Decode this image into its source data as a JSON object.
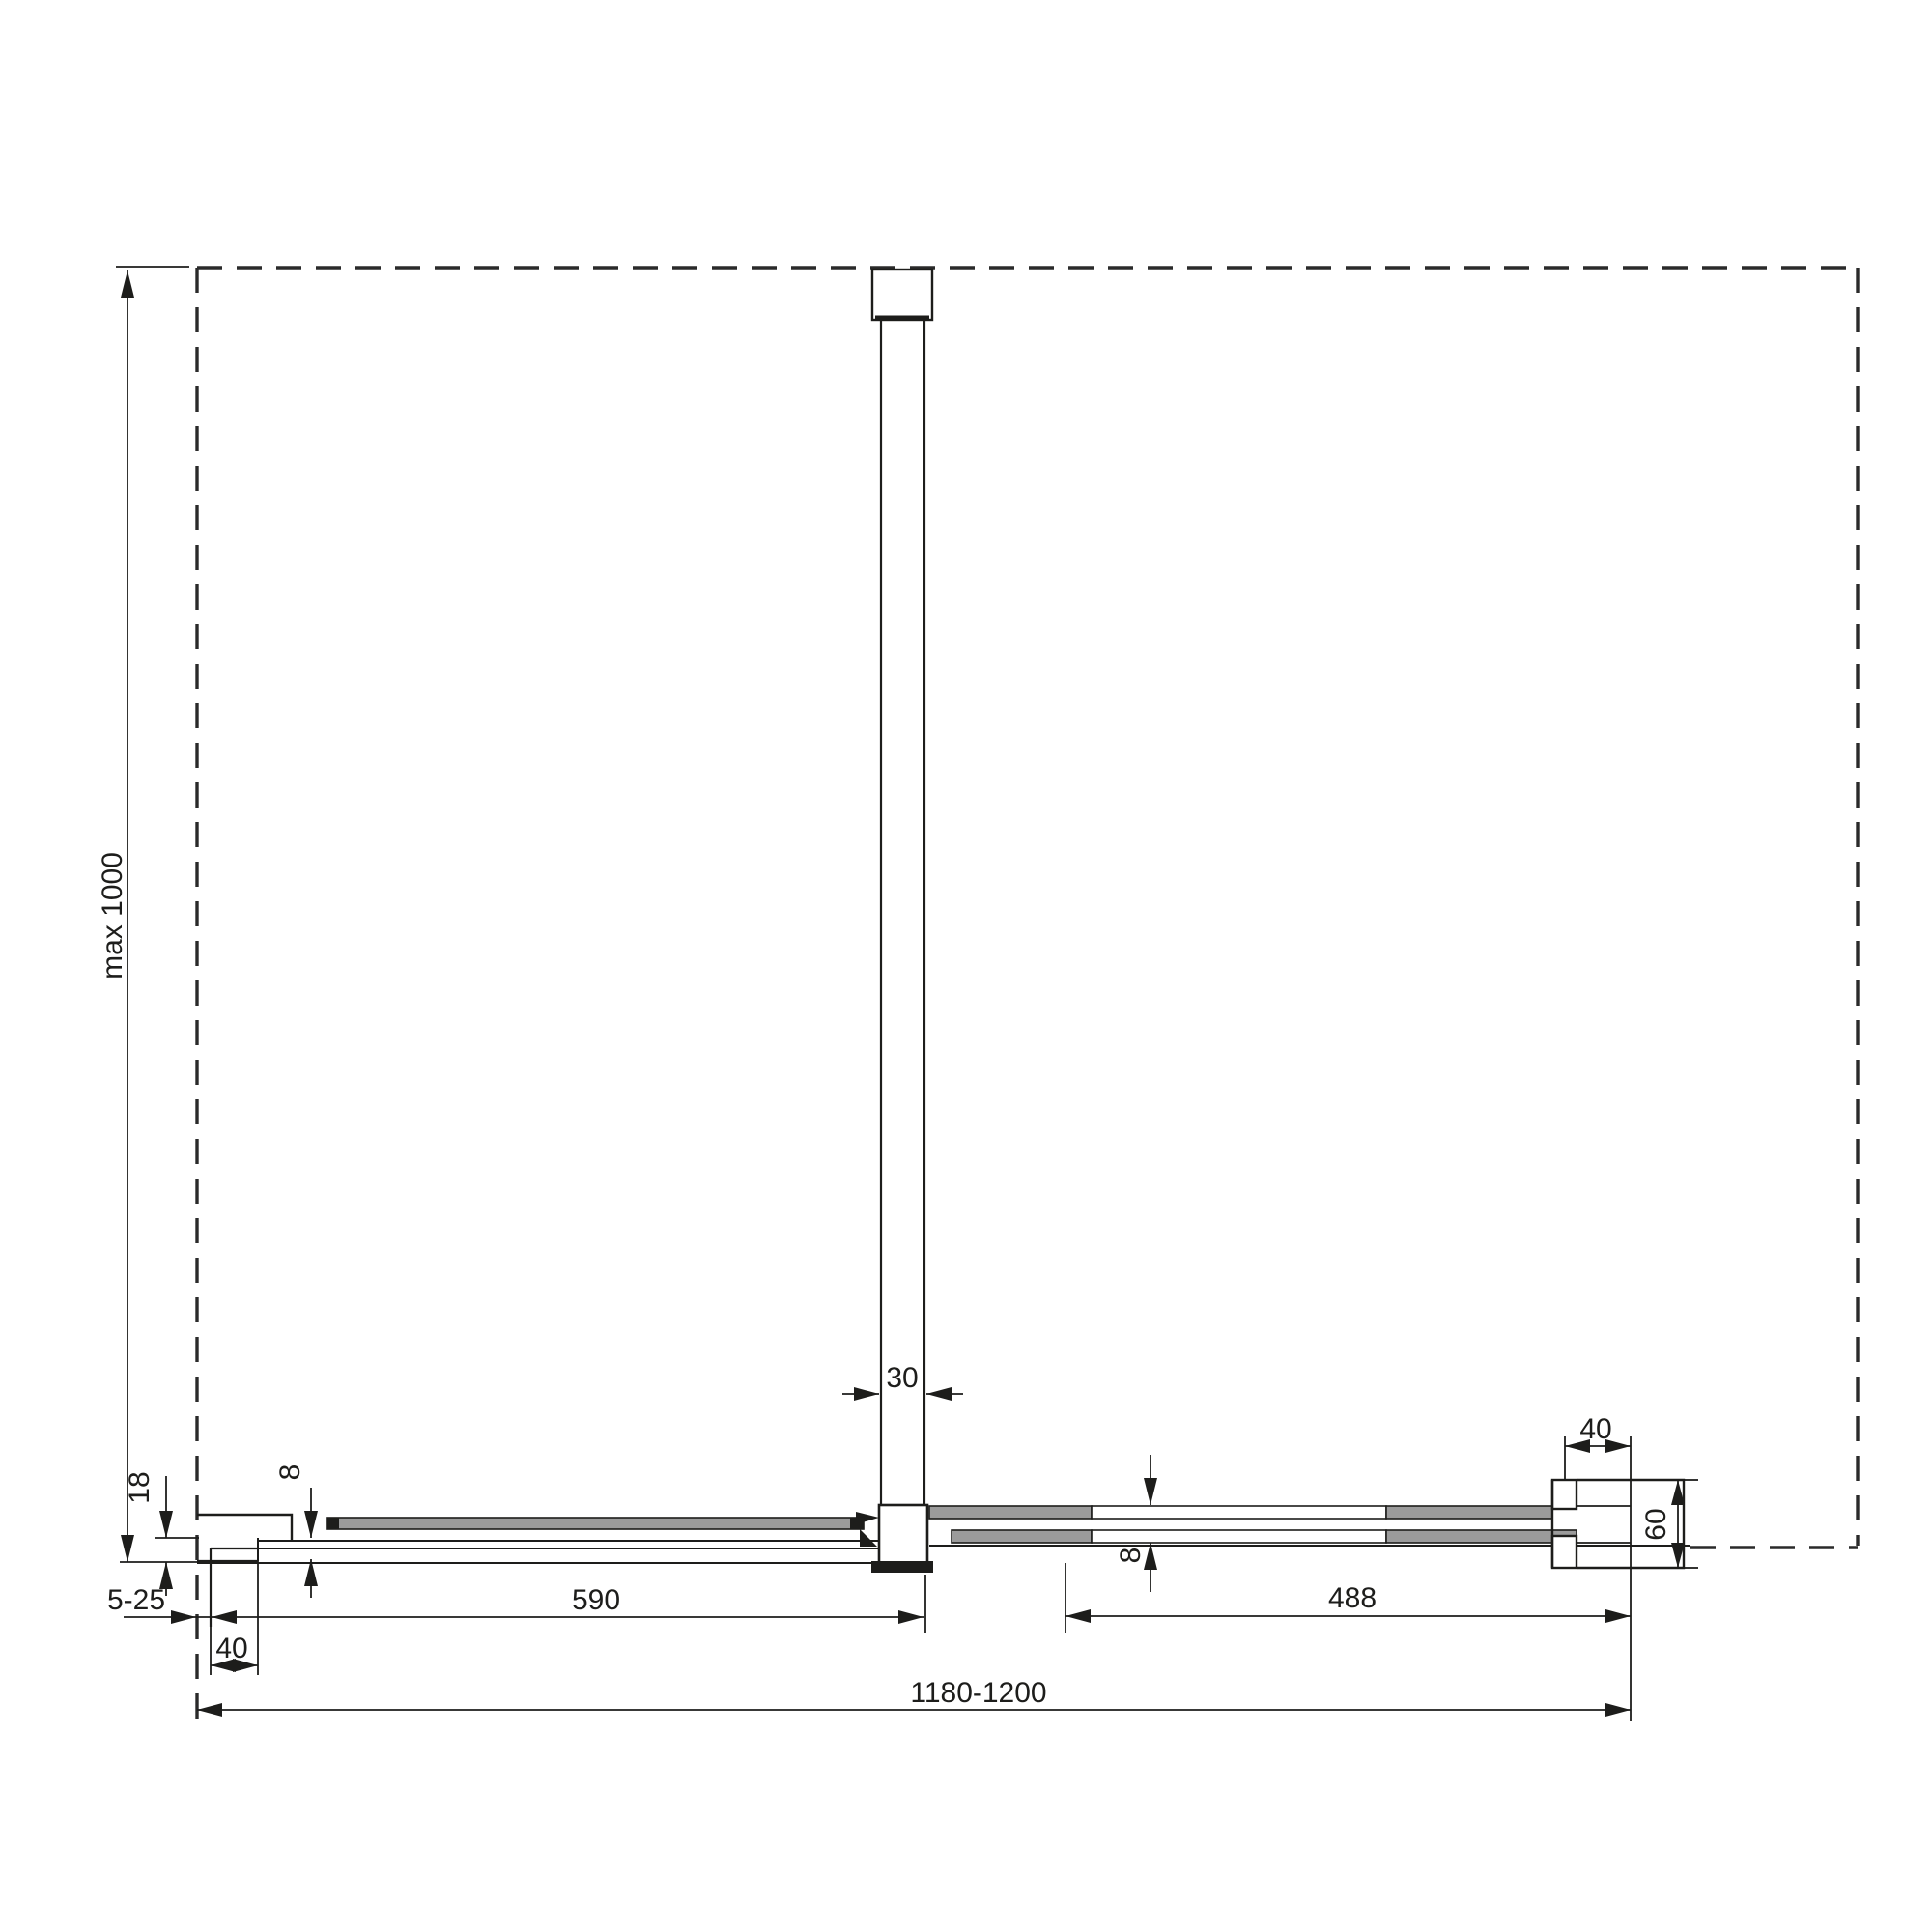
{
  "drawing": {
    "background": "#ffffff",
    "line_color": "#1d1d1b",
    "rail_fill": "#9b9b9b",
    "labels": {
      "max_height": "max 1000",
      "wall_offset": "18",
      "glass_thickness_left": "8",
      "wall_adjustment": "5-25",
      "wall_profile_width": "40",
      "brace_profile": "30",
      "fixed_panel": "590",
      "glass_thickness_right": "8",
      "moving_panel": "488",
      "end_profile_width": "40",
      "return_panel_depth": "60",
      "overall_width": "1180-1200"
    }
  }
}
